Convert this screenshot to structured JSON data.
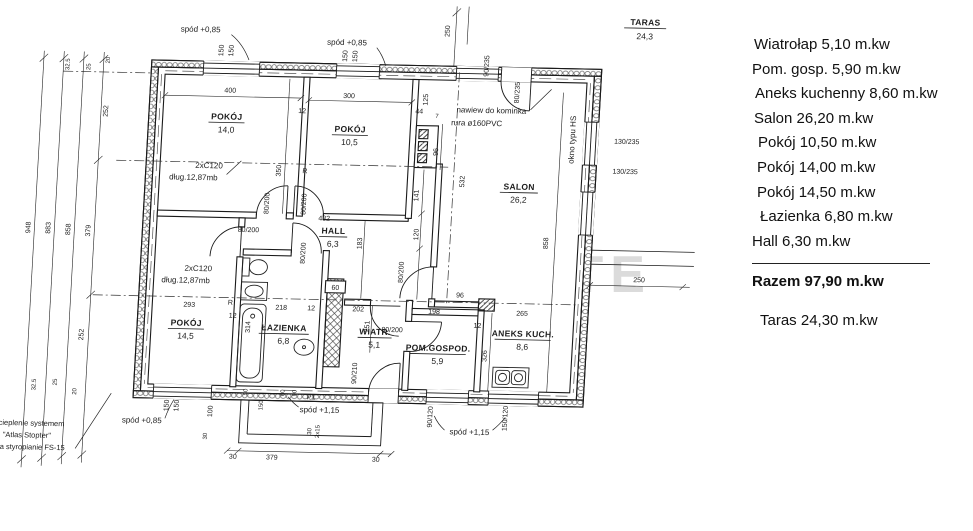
{
  "watermark": "BESTATE",
  "legend": {
    "items": [
      "Wiatrołap 5,10 m.kw",
      "Pom. gosp. 5,90 m.kw",
      "Aneks kuchenny 8,60 m.kw",
      "Salon 26,20 m.kw",
      "Pokój 10,50 m.kw",
      "Pokój 14,00 m.kw",
      "Pokój 14,50 m.kw",
      "Łazienka 6,80 m.kw",
      "Hall 6,30 m.kw"
    ],
    "razem": "Razem 97,90 m.kw",
    "taras": "Taras 24,30 m.kw"
  },
  "rooms": {
    "r14_0": {
      "name": "POKÓJ",
      "area": "14,0"
    },
    "r10_5": {
      "name": "POKÓJ",
      "area": "10,5"
    },
    "salon": {
      "name": "SALON",
      "area": "26,2"
    },
    "hall": {
      "name": "HALL",
      "area": "6,3"
    },
    "r14_5": {
      "name": "POKÓJ",
      "area": "14,5"
    },
    "lazienka": {
      "name": "ŁAZIENKA",
      "area": "6,8"
    },
    "wiatr": {
      "name": "WIATR.",
      "area": "5,1"
    },
    "pomgosp": {
      "name": "POM.GOSPOD.",
      "area": "5,9"
    },
    "aneks": {
      "name": "ANEKS KUCH.",
      "area": "8,6"
    },
    "taras": {
      "name": "TARAS",
      "area": "24,3"
    }
  },
  "annotations": {
    "spod085": "spód +0,85",
    "spod115": "spód +1,15",
    "naw1": "nawiew do kominka",
    "naw2": "rura ø160PVC",
    "okno": "okno typu HS",
    "c1": "2xC120",
    "c2": "dług.12,87mb",
    "oc1": "ocieplenie systemem",
    "oc2": "\"Atlas Stopter\"",
    "oc3": "na styropianie FS-15",
    "p1": "P1",
    "r": "R"
  },
  "dims": {
    "d948": "948",
    "d883": "883",
    "d858": "858",
    "d379": "379",
    "d252": "252",
    "d32_5": "32.5",
    "d25": "25",
    "d20": "20",
    "d400": "400",
    "d300": "300",
    "d12": "12",
    "d150": "150",
    "d250": "250",
    "d350": "350",
    "d532": "532",
    "d141": "141",
    "d120": "120",
    "d183": "183",
    "d432": "432",
    "d218": "218",
    "d202": "202",
    "d198": "198",
    "d265": "265",
    "d96": "96",
    "d293": "293",
    "d251": "251",
    "d314": "314",
    "d326": "326",
    "d44": "44",
    "d125": "125",
    "d7": "7",
    "d60": "60",
    "d100": "100",
    "d30": "30",
    "d50": "50",
    "d90": "90",
    "d2x15": "2x15",
    "f80_200": "80/200",
    "f90_210": "90/210",
    "f90_120": "90/120",
    "f150_120": "150/120",
    "f90_235": "90/235",
    "f80_235": "80/235",
    "f130_235": "130/235"
  }
}
